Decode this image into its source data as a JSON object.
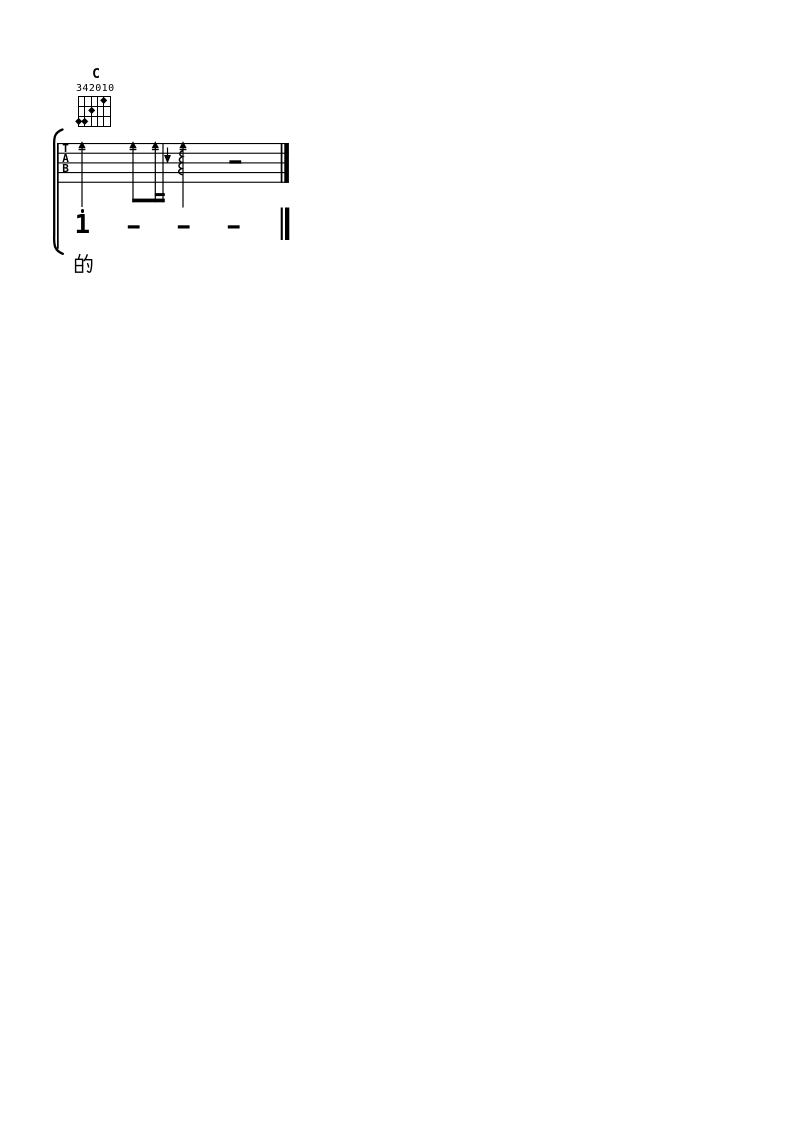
{
  "colors": {
    "ink": "#000000",
    "background": "#ffffff"
  },
  "chord_diagram": {
    "name": "C",
    "fingering": "342010",
    "strings": 6,
    "frets_shown": 3,
    "dots": [
      {
        "string": 6,
        "fret": 3
      },
      {
        "string": 5,
        "fret": 3
      },
      {
        "string": 4,
        "fret": 2
      },
      {
        "string": 2,
        "fret": 1
      }
    ]
  },
  "tab_staff": {
    "labels": [
      "T",
      "A",
      "B"
    ],
    "strums": [
      {
        "direction": "up",
        "value": "quarter",
        "arpeggio": false
      },
      {
        "direction": "up",
        "value": "eighth",
        "arpeggio": false
      },
      {
        "direction": "up",
        "value": "sixteenth",
        "arpeggio": false
      },
      {
        "direction": "down",
        "value": "sixteenth",
        "arpeggio": false
      },
      {
        "direction": "up",
        "value": "quarter",
        "arpeggio": true
      }
    ],
    "rest": "half-rest dash",
    "end_barline": "final"
  },
  "melody_line": {
    "notation": "jianpu",
    "notes": [
      {
        "type": "digit",
        "value": "1",
        "octave": "high"
      },
      {
        "type": "dash",
        "value": "—"
      },
      {
        "type": "dash",
        "value": "—"
      },
      {
        "type": "dash",
        "value": "—"
      }
    ],
    "end_barline": "final"
  },
  "lyrics": {
    "text": "的"
  }
}
